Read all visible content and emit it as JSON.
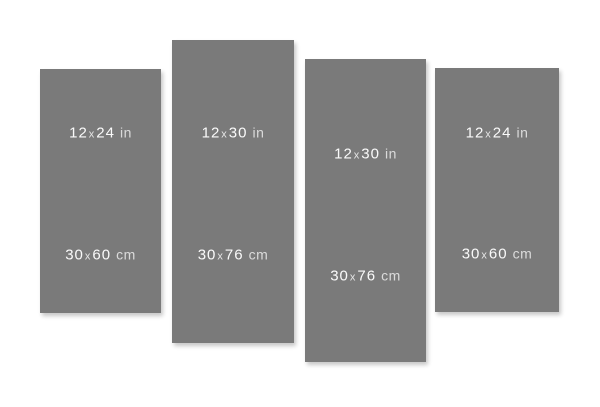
{
  "style": {
    "page_background": "#ffffff",
    "panel_color": "#7a7a7a",
    "label_color": "#fafafa"
  },
  "panels": [
    {
      "id": "panel-1",
      "inches": {
        "a": "12",
        "x": "x",
        "b": "24",
        "unit": "in"
      },
      "cm": {
        "a": "30",
        "x": "x",
        "b": "60",
        "unit": "cm"
      }
    },
    {
      "id": "panel-2",
      "inches": {
        "a": "12",
        "x": "x",
        "b": "30",
        "unit": "in"
      },
      "cm": {
        "a": "30",
        "x": "x",
        "b": "76",
        "unit": "cm"
      }
    },
    {
      "id": "panel-3",
      "inches": {
        "a": "12",
        "x": "x",
        "b": "30",
        "unit": "in"
      },
      "cm": {
        "a": "30",
        "x": "x",
        "b": "76",
        "unit": "cm"
      }
    },
    {
      "id": "panel-4",
      "inches": {
        "a": "12",
        "x": "x",
        "b": "24",
        "unit": "in"
      },
      "cm": {
        "a": "30",
        "x": "x",
        "b": "60",
        "unit": "cm"
      }
    }
  ]
}
